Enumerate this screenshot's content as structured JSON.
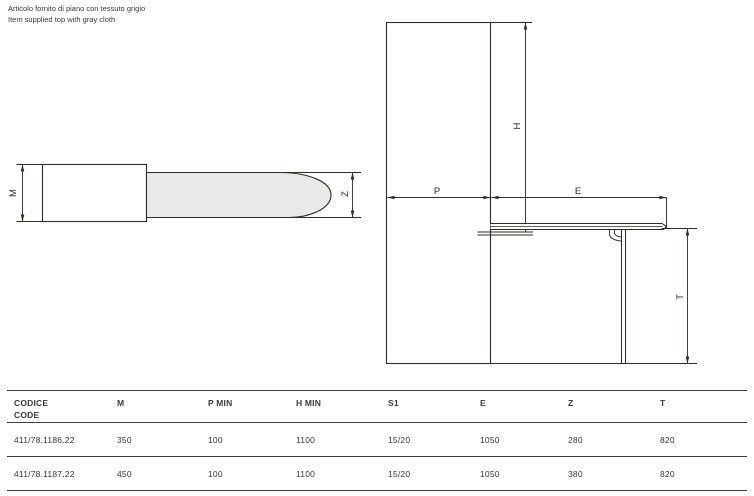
{
  "note": {
    "heading": "NOTE",
    "line_italian": "Articolo fornito di piano con tessuto grigio",
    "line_english": "Item supplied top with gray cloth"
  },
  "drawings": {
    "top_view": {
      "label_m": "M",
      "label_z": "Z"
    },
    "side_view": {
      "label_p": "P",
      "label_e": "E",
      "label_h": "H",
      "label_t": "T"
    }
  },
  "colors": {
    "drawing_line": "#332a24",
    "board_fill": "#e9e9e7",
    "text": "#3b3b3b",
    "table_rule": "#3f3f3f"
  },
  "table": {
    "headers": {
      "code_line1": "CODICE",
      "code_line2": "CODE",
      "m": "M",
      "p_min": "P MIN",
      "h_min": "H MIN",
      "s1": "S1",
      "e": "E",
      "z": "Z",
      "t": "T"
    },
    "rows": [
      {
        "code": "411/78.1186.22",
        "m": "350",
        "p_min": "100",
        "h_min": "1100",
        "s1": "15/20",
        "e": "1050",
        "z": "280",
        "t": "820"
      },
      {
        "code": "411/78.1187.22",
        "m": "450",
        "p_min": "100",
        "h_min": "1100",
        "s1": "15/20",
        "e": "1050",
        "z": "380",
        "t": "820"
      }
    ]
  }
}
